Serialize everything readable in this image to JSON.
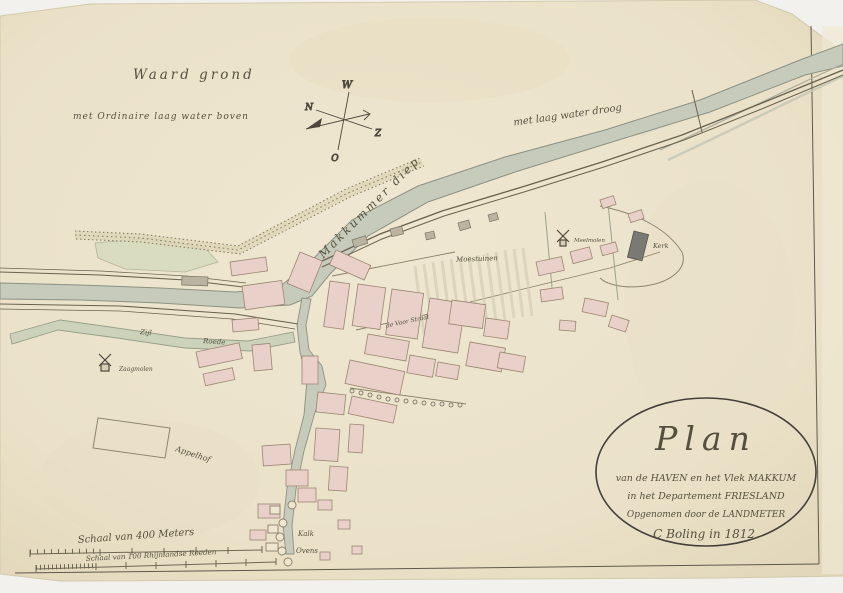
{
  "colors": {
    "paper": "#ebe2ca",
    "water": "#c7cbbc",
    "water_green": "#cdd3bb",
    "buildings_pink": "#e9d0c8",
    "church_grey": "#7b7974",
    "ink": "#55503e",
    "line_brown": "#6e6753"
  },
  "compass": {
    "west": "W",
    "north": "N",
    "east": "O",
    "south": "Z"
  },
  "labels": {
    "waard_grond": "Waard grond",
    "laag_water_boven": "met Ordinaire laag water boven",
    "laag_water_droog": "met laag water droog",
    "makkumer_diep": "Makkummer diep",
    "moestuinen": "Moestuinen",
    "kerk": "Kerk",
    "meelmolen": "Meelmolen",
    "zaagmolen": "Zaagmolen",
    "appelhof": "Appelhof",
    "kalk": "Kalk",
    "ovens": "Ovens",
    "zijl": "Zijl",
    "roede": "Roede",
    "voorstraat": "de Voor Straat"
  },
  "cartouche": {
    "title": "Plan",
    "line2": "van de HAVEN en het Vlek MAKKUM",
    "line3": "in het Departement FRIESLAND",
    "line4": "Opgenomen door de LANDMETER",
    "line5": "C Boling in 1812."
  },
  "scalebars": {
    "meters": "Schaal van 400 Meters",
    "roeden": "Schaal van 100 Rhijnlandse Roeden"
  }
}
